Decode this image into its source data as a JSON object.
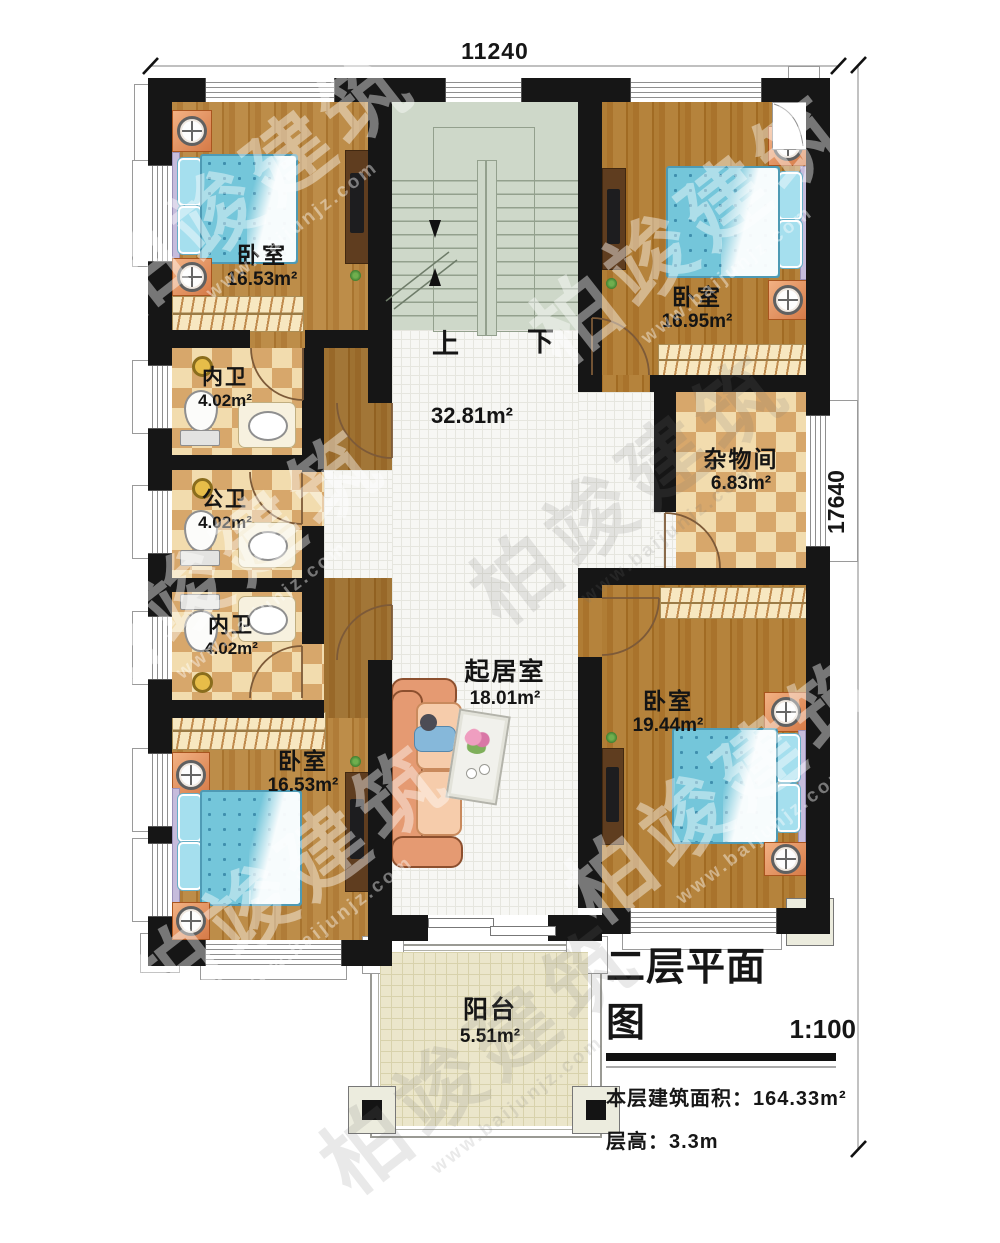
{
  "watermark": {
    "brand": "柏竣建筑",
    "url": "www.baijunjz.com"
  },
  "dimensions": {
    "width_top": "11240",
    "height_right": "17640"
  },
  "stairs": {
    "up": "上",
    "down": "下"
  },
  "rooms": {
    "bedroom_tl": {
      "name": "卧室",
      "area": "16.53m²"
    },
    "bedroom_tr": {
      "name": "卧室",
      "area": "16.95m²"
    },
    "bath_top": {
      "name": "内卫",
      "area": "4.02m²"
    },
    "bath_mid": {
      "name": "公卫",
      "area": "4.02m²"
    },
    "bath_bottom": {
      "name": "内卫",
      "area": "4.02m²"
    },
    "storage": {
      "name": "杂物间",
      "area": "6.83m²"
    },
    "hall": {
      "area": "32.81m²"
    },
    "living": {
      "name": "起居室",
      "area": "18.01m²"
    },
    "bedroom_br": {
      "name": "卧室",
      "area": "19.44m²"
    },
    "bedroom_bl": {
      "name": "卧室",
      "area": "16.53m²"
    },
    "balcony": {
      "name": "阳台",
      "area": "5.51m²"
    }
  },
  "title_block": {
    "title": "二层平面图",
    "scale": "1:100",
    "area_line": "本层建筑面积：164.33m²",
    "height_line": "层高：3.3m"
  }
}
